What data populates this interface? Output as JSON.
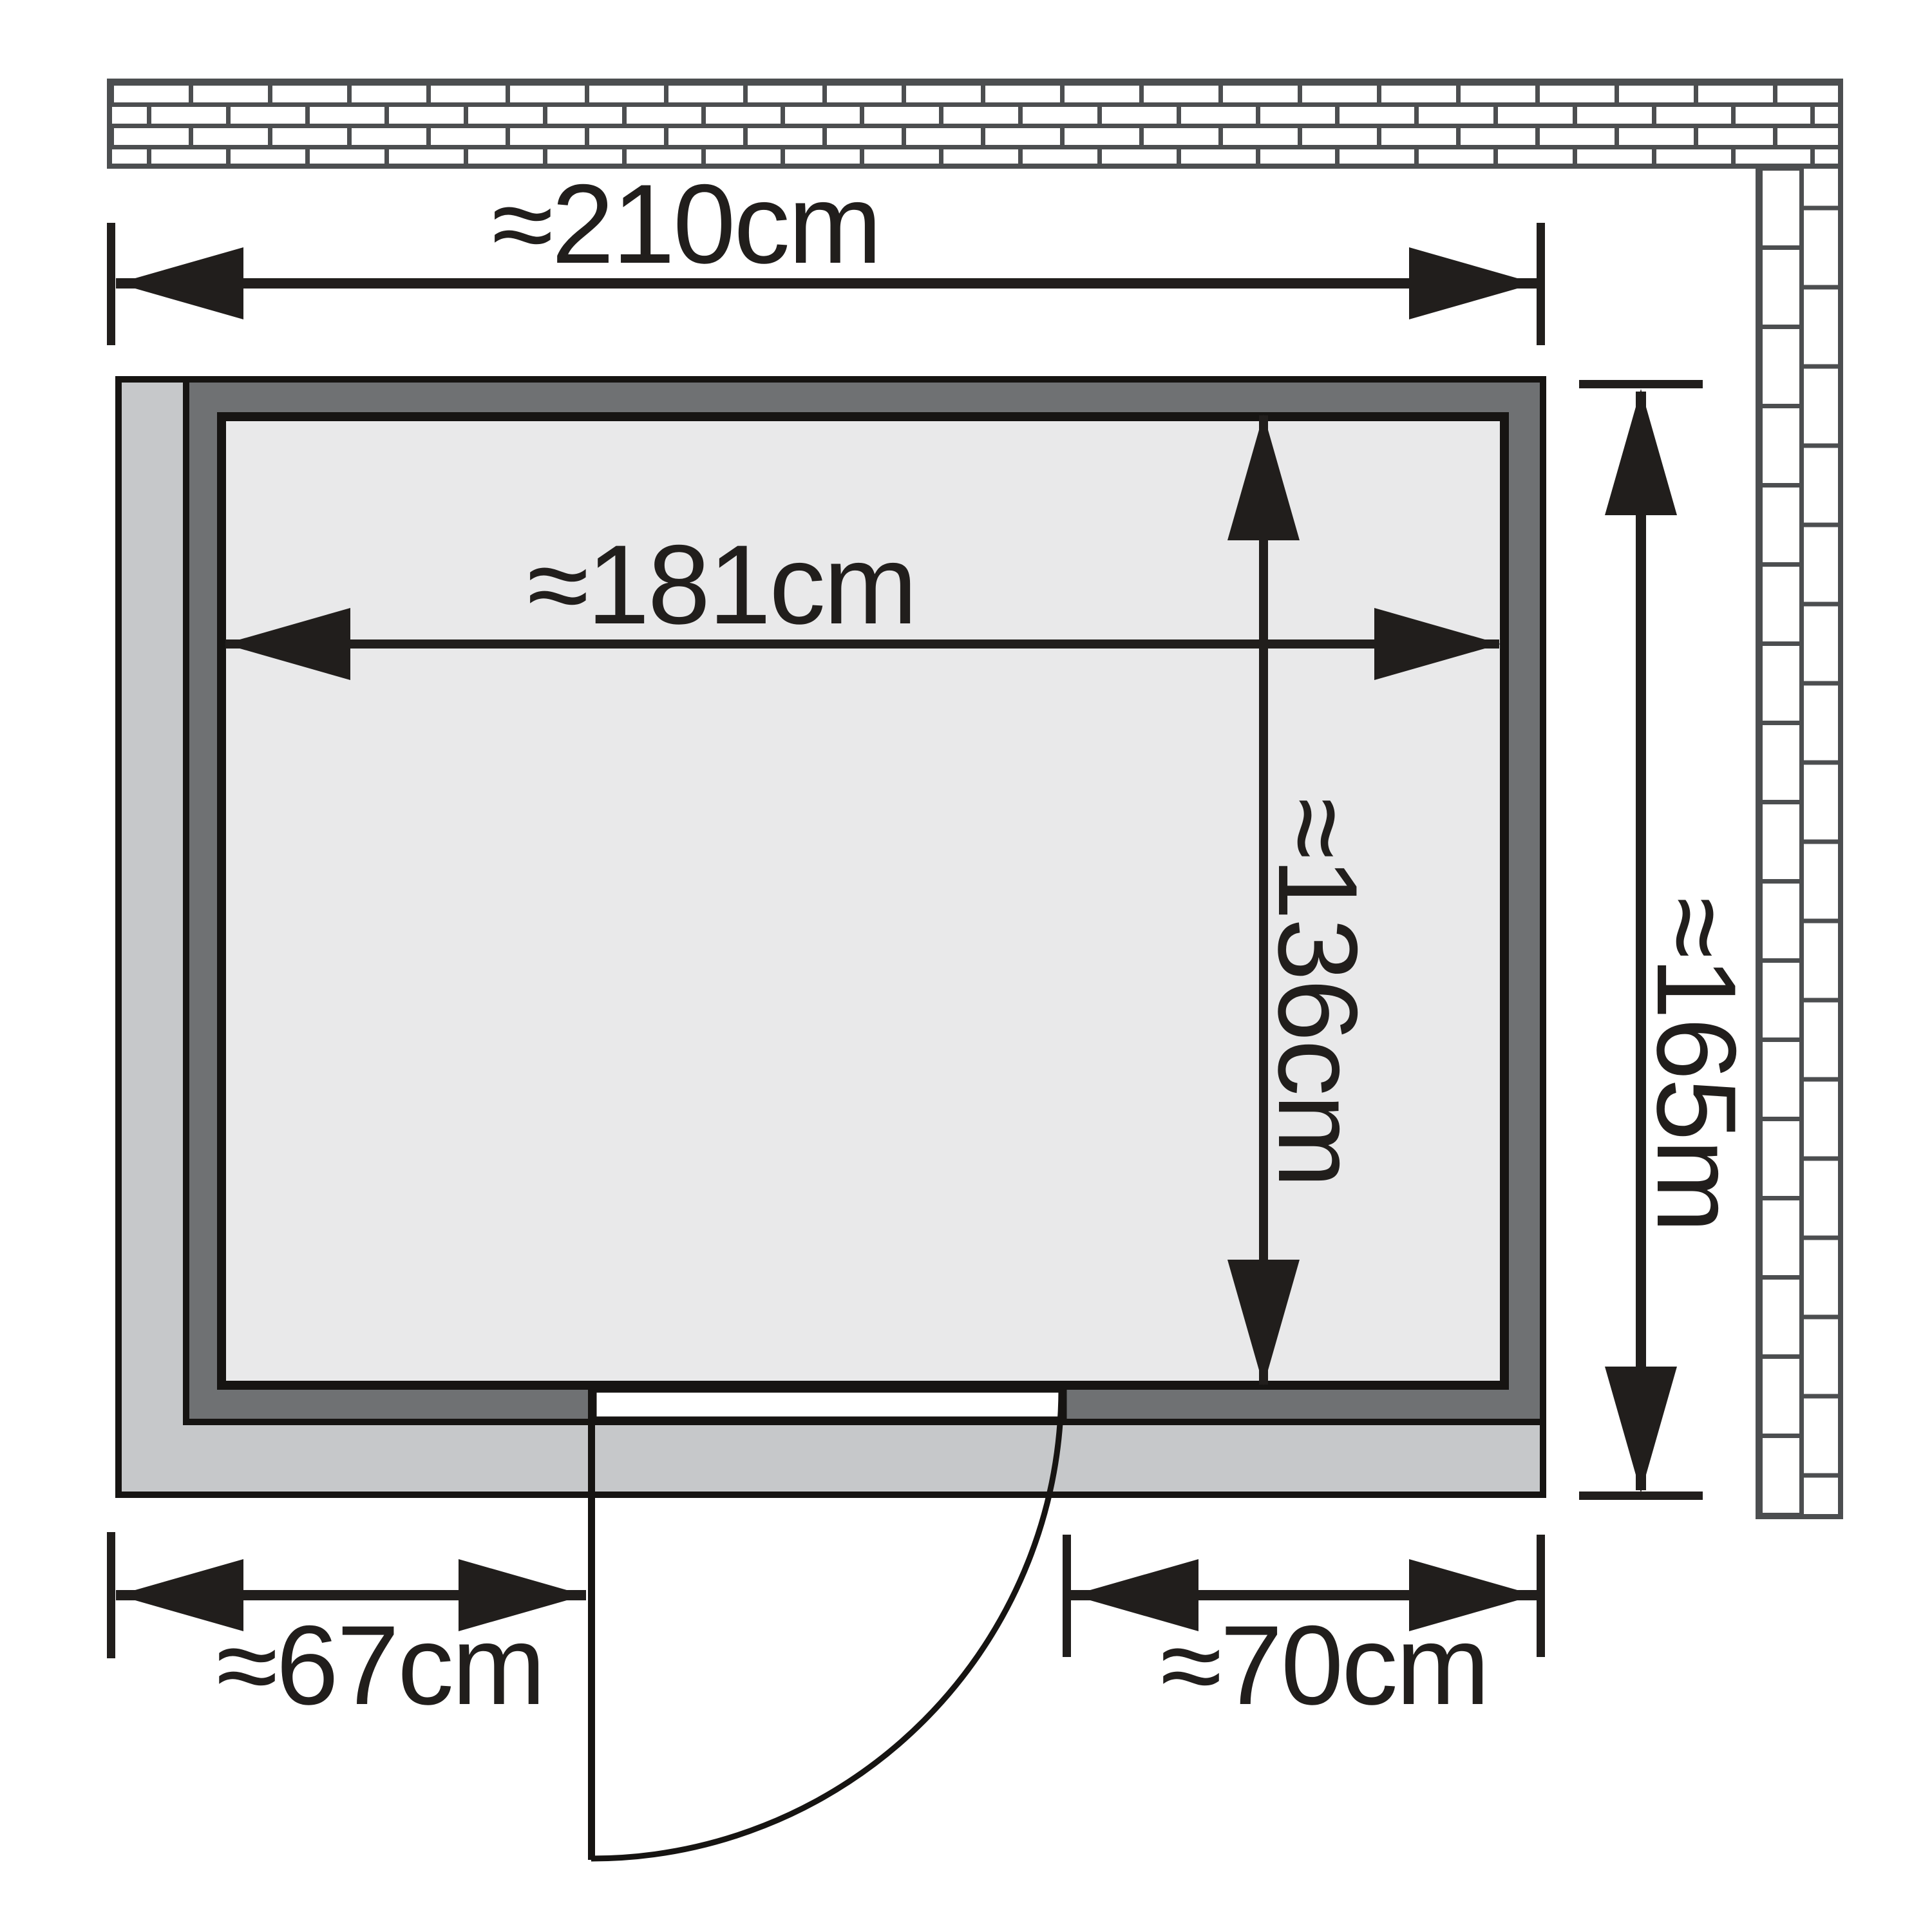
{
  "diagram": {
    "type": "floor-plan",
    "subject": "sauna-room-top-view",
    "labels": {
      "outer_width": "≈210cm",
      "inner_width": "≈181cm",
      "inner_depth": "≈136cm",
      "outer_depth": "≈165m",
      "door_offset_left": "≈67cm",
      "door_offset_right": "≈70cm"
    },
    "colors": {
      "ink": "#211e1c",
      "outline": "#161412",
      "interior_fill": "#e9e9ea",
      "wall_fill": "#6f7173",
      "platform_fill": "#c6c8ca",
      "door_fill": "#ffffff",
      "brick_joint": "#4c4e50",
      "background": "#ffffff"
    }
  }
}
